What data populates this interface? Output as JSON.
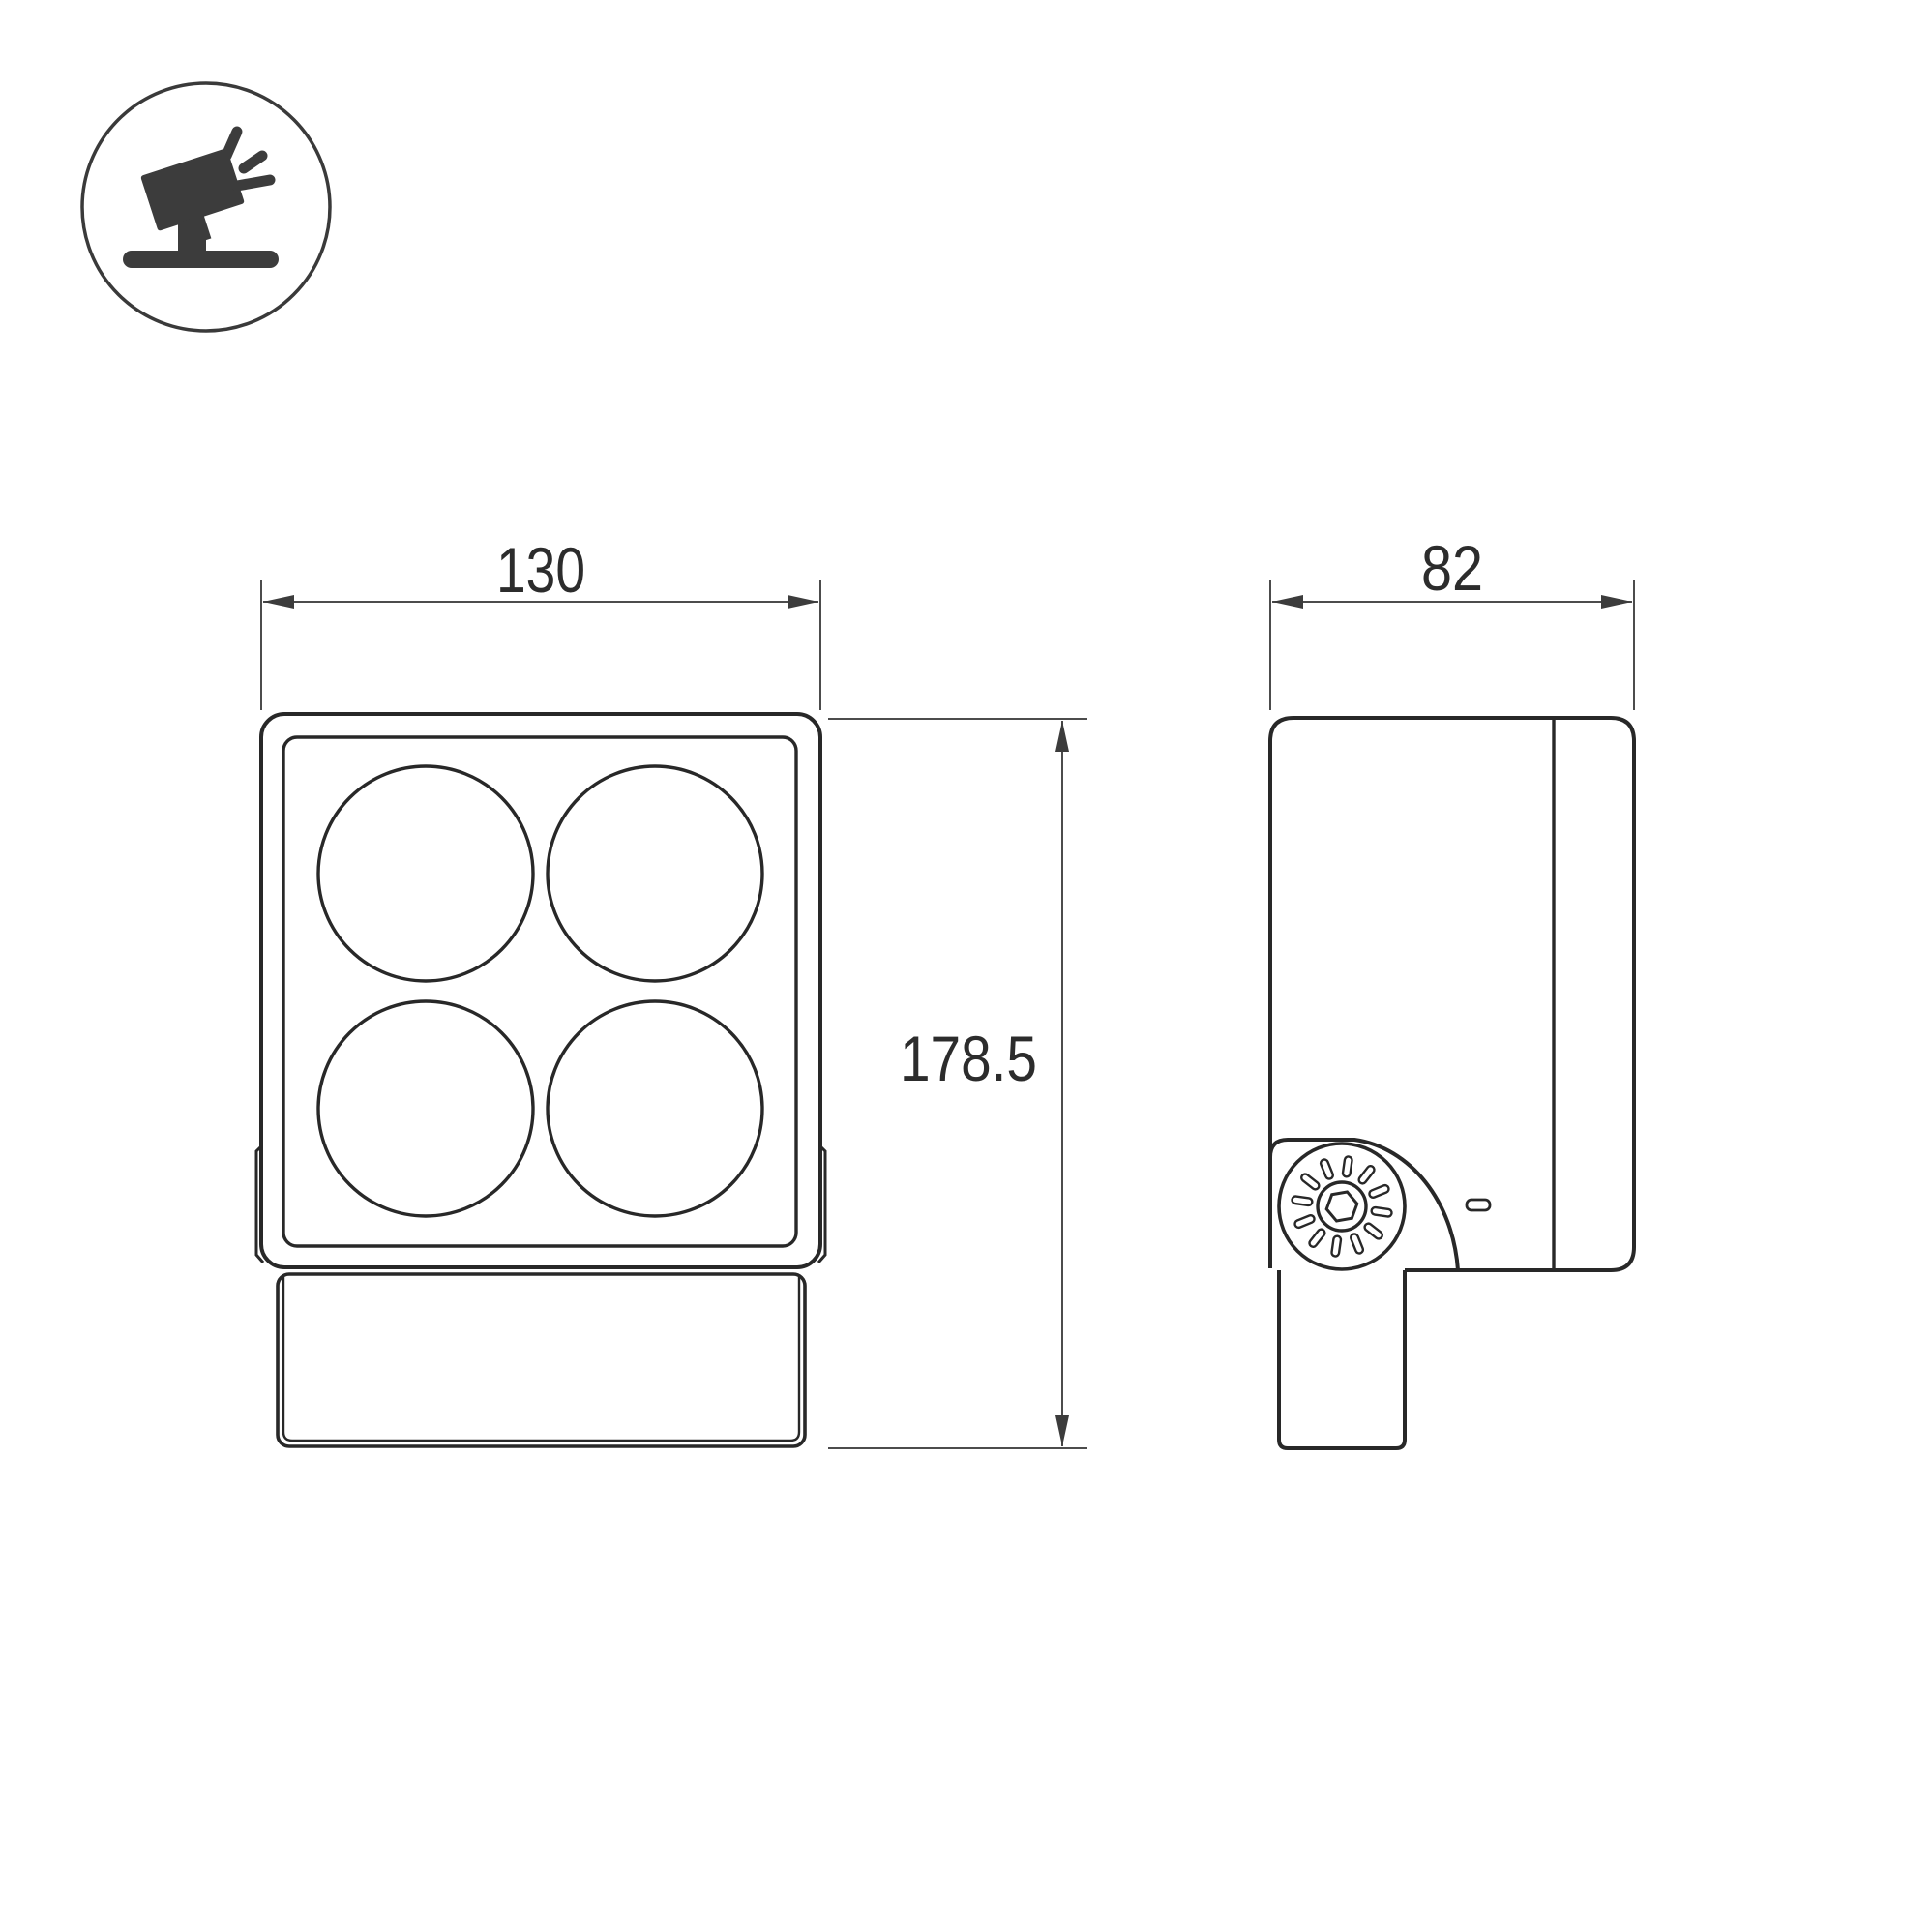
{
  "drawing": {
    "type": "technical-dimension-drawing",
    "subject": "floodlight-luminaire",
    "dimensions": {
      "front_width": {
        "label": "130"
      },
      "side_depth": {
        "label": "82"
      },
      "total_height": {
        "label": "178.5"
      }
    },
    "front_view": {
      "lens_count": "4"
    },
    "icon": {
      "name": "floodlight-icon"
    },
    "colors": {
      "background": "#ffffff",
      "object_line": "#282828",
      "dimension_line": "#4c4c4c",
      "arrow_fill": "#3c3c3c",
      "text": "#2c2c2c",
      "icon_fill": "#3c3c3c"
    }
  }
}
